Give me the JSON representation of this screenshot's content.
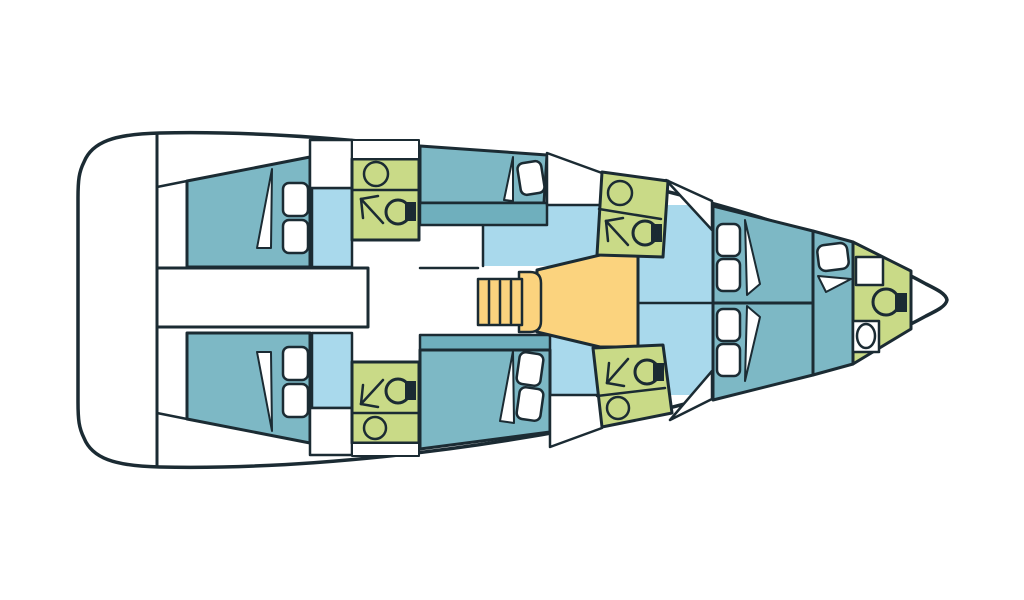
{
  "diagram": {
    "type": "sailing-yacht-interior-deck-plan",
    "orientation": "bow-right-stern-left",
    "rooms": [
      {
        "id": "aft-port-cabin",
        "kind": "double-berth-cabin"
      },
      {
        "id": "aft-starboard-cabin",
        "kind": "double-berth-cabin"
      },
      {
        "id": "aft-port-head",
        "kind": "bathroom-with-shower"
      },
      {
        "id": "aft-starboard-head",
        "kind": "bathroom-with-shower"
      },
      {
        "id": "central-corridor",
        "kind": "passage"
      },
      {
        "id": "mid-port-cabin",
        "kind": "double-berth-cabin"
      },
      {
        "id": "mid-starboard-cabin",
        "kind": "double-berth-cabin"
      },
      {
        "id": "saloon",
        "kind": "open-floor"
      },
      {
        "id": "galley",
        "kind": "galley"
      },
      {
        "id": "companionway-stairs",
        "kind": "stairs"
      },
      {
        "id": "mid-forward-port-head",
        "kind": "bathroom-with-shower"
      },
      {
        "id": "mid-forward-starboard-head",
        "kind": "bathroom-with-shower"
      },
      {
        "id": "forward-port-cabin",
        "kind": "double-berth-cabin"
      },
      {
        "id": "forward-starboard-cabin",
        "kind": "double-berth-cabin"
      },
      {
        "id": "bow-berth",
        "kind": "berth"
      },
      {
        "id": "bow-head",
        "kind": "bathroom"
      }
    ],
    "fixture_icons": [
      "pillow-icon",
      "blanket-fold-icon",
      "sink-icon",
      "toilet-icon",
      "shower-arrow-icon",
      "stairs-icon"
    ]
  },
  "colors": {
    "outline": "#1b2b33",
    "white": "#ffffff",
    "cabin": "#7db8c5",
    "shelf": "#6fafbd",
    "floor": "#a9d9ec",
    "head": "#c9da87",
    "galley": "#fbd37e"
  }
}
